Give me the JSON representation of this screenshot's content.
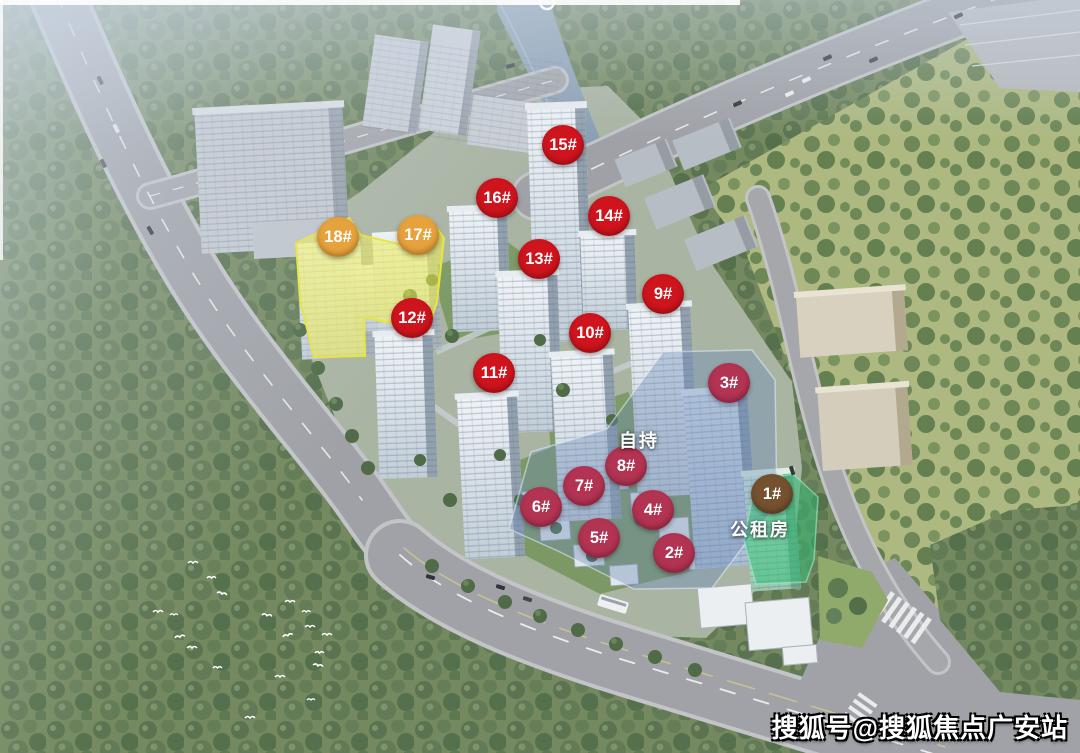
{
  "marker_colors": {
    "red": {
      "bg": "#CE141D",
      "edge": "#9E0C12"
    },
    "crimson": {
      "bg": "#B23352",
      "edge": "#8C2440"
    },
    "orange": {
      "bg": "#E6A23C",
      "edge": "#C07F22"
    },
    "brown": {
      "bg": "#74512F",
      "edge": "#55381E"
    }
  },
  "overlay_colors": {
    "yellow": "#F0EC3C",
    "blue": "#6E8CB9",
    "green": "#2CBE76"
  },
  "markers": [
    {
      "label": "1#",
      "x": 772,
      "y": 494,
      "type": "brown"
    },
    {
      "label": "2#",
      "x": 674,
      "y": 553,
      "type": "crimson"
    },
    {
      "label": "3#",
      "x": 729,
      "y": 383,
      "type": "crimson"
    },
    {
      "label": "4#",
      "x": 653,
      "y": 510,
      "type": "crimson"
    },
    {
      "label": "5#",
      "x": 599,
      "y": 538,
      "type": "crimson"
    },
    {
      "label": "6#",
      "x": 541,
      "y": 507,
      "type": "crimson"
    },
    {
      "label": "7#",
      "x": 584,
      "y": 486,
      "type": "crimson"
    },
    {
      "label": "8#",
      "x": 626,
      "y": 466,
      "type": "crimson"
    },
    {
      "label": "9#",
      "x": 663,
      "y": 294,
      "type": "red"
    },
    {
      "label": "10#",
      "x": 590,
      "y": 333,
      "type": "red"
    },
    {
      "label": "11#",
      "x": 494,
      "y": 373,
      "type": "red"
    },
    {
      "label": "12#",
      "x": 412,
      "y": 318,
      "type": "red"
    },
    {
      "label": "13#",
      "x": 539,
      "y": 259,
      "type": "red"
    },
    {
      "label": "14#",
      "x": 609,
      "y": 216,
      "type": "red"
    },
    {
      "label": "15#",
      "x": 563,
      "y": 145,
      "type": "red"
    },
    {
      "label": "16#",
      "x": 497,
      "y": 198,
      "type": "red"
    },
    {
      "label": "17#",
      "x": 418,
      "y": 235,
      "type": "orange"
    },
    {
      "label": "18#",
      "x": 338,
      "y": 237,
      "type": "orange"
    }
  ],
  "area_labels": [
    {
      "name": "self-held-area-label",
      "text": "自持",
      "x": 639,
      "y": 440
    },
    {
      "name": "public-rental-housing-label",
      "text": "公租房",
      "x": 760,
      "y": 529
    }
  ],
  "watermark": {
    "text": "搜狐号@搜狐焦点广安站"
  }
}
